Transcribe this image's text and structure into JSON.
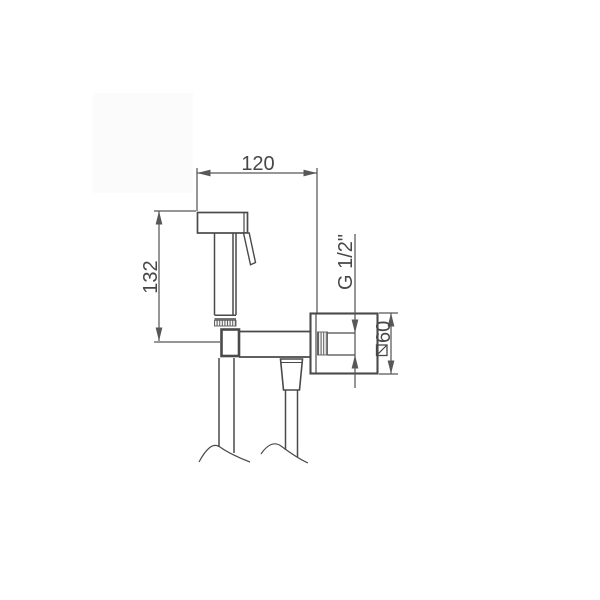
{
  "theme": {
    "bg": "#ffffff",
    "line-color": "#4a4a4a",
    "dim-color": "#585858",
    "text-color": "#474747"
  },
  "drawing": {
    "kind": "technical-dimension-drawing",
    "subject": "wall-mounted hand bidet sprayer with hose",
    "dimensions": {
      "width": {
        "label": "120"
      },
      "height": {
        "label": "132"
      },
      "thread": {
        "label": "G 1/2\""
      },
      "plate_size": {
        "label": "60",
        "symbol": "square-section-icon"
      }
    }
  }
}
